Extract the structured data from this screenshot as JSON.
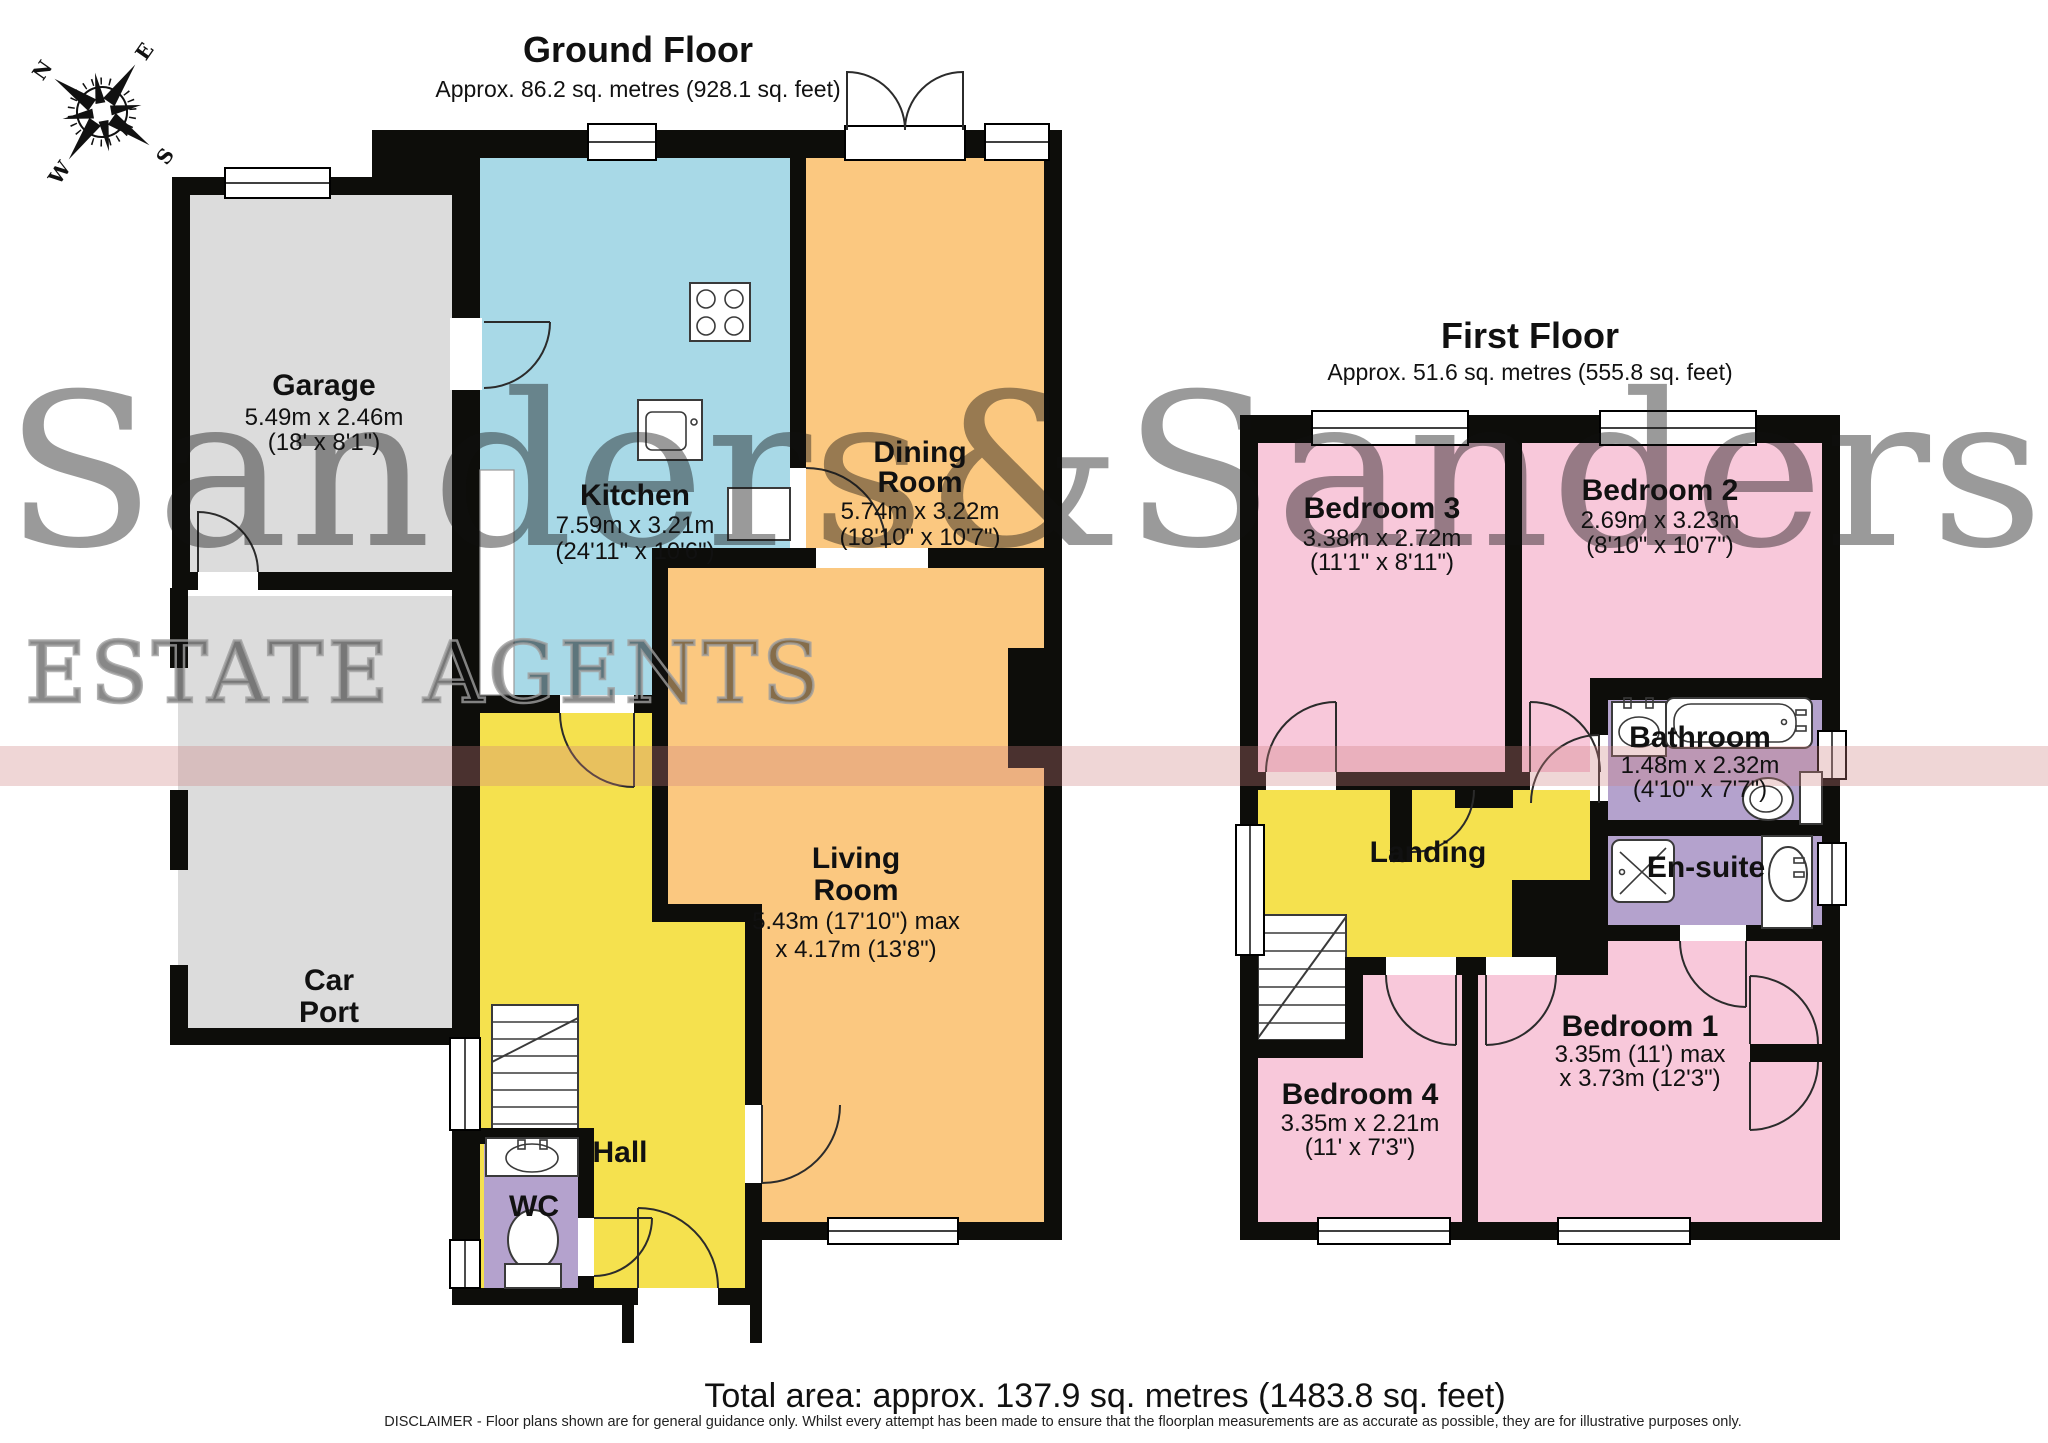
{
  "watermark": {
    "brand": "Sanders&Sanders",
    "tagline": "ESTATE AGENTS"
  },
  "compass": {
    "north": "N",
    "east": "E",
    "south": "S",
    "west": "W"
  },
  "colors": {
    "wall": "#0d0d0a",
    "garage": "#dcdcdc",
    "kitchen": "#a8d9e7",
    "living": "#fbc880",
    "hall": "#f5e14e",
    "bedroom": "#f8c8da",
    "bathroom": "#b4a2cd",
    "watermark_grey": "#8a8a8a",
    "stripe_red": "#cc7f7f"
  },
  "ground_floor": {
    "title": "Ground Floor",
    "area": "Approx. 86.2 sq. metres (928.1 sq. feet)",
    "rooms": {
      "garage": {
        "name": "Garage",
        "metric": "5.49m x 2.46m",
        "imperial": "(18' x 8'1\")"
      },
      "car_port": {
        "line1": "Car",
        "line2": "Port"
      },
      "kitchen": {
        "name": "Kitchen",
        "metric": "7.59m x 3.21m",
        "imperial": "(24'11\" x 10'6\")"
      },
      "dining_room": {
        "line1": "Dining",
        "line2": "Room",
        "metric": "5.74m x 3.22m",
        "imperial": "(18'10\" x 10'7\")"
      },
      "living_room": {
        "line1": "Living",
        "line2": "Room",
        "metric": "5.43m (17'10\") max",
        "imperial": "x 4.17m (13'8\")"
      },
      "hall": {
        "name": "Hall"
      },
      "wc": {
        "name": "WC"
      }
    }
  },
  "first_floor": {
    "title": "First Floor",
    "area": "Approx. 51.6 sq. metres (555.8 sq. feet)",
    "rooms": {
      "bedroom3": {
        "name": "Bedroom 3",
        "metric": "3.38m x 2.72m",
        "imperial": "(11'1\" x 8'11\")"
      },
      "bedroom2": {
        "name": "Bedroom 2",
        "metric": "2.69m x 3.23m",
        "imperial": "(8'10\" x 10'7\")"
      },
      "bathroom": {
        "name": "Bathroom",
        "metric": "1.48m x 2.32m",
        "imperial": "(4'10\" x 7'7\")"
      },
      "en_suite": {
        "name": "En-suite"
      },
      "landing": {
        "name": "Landing"
      },
      "bedroom4": {
        "name": "Bedroom 4",
        "metric": "3.35m x 2.21m",
        "imperial": "(11' x 7'3\")"
      },
      "bedroom1": {
        "name": "Bedroom 1",
        "metric": "3.35m (11') max",
        "imperial": "x 3.73m (12'3\")"
      }
    }
  },
  "footer": {
    "total_area": "Total area: approx. 137.9 sq. metres (1483.8 sq. feet)",
    "disclaimer": "DISCLAIMER - Floor plans shown are for general guidance only. Whilst every attempt has been made to ensure that the floorplan measurements are as accurate as possible, they are for illustrative purposes only."
  }
}
